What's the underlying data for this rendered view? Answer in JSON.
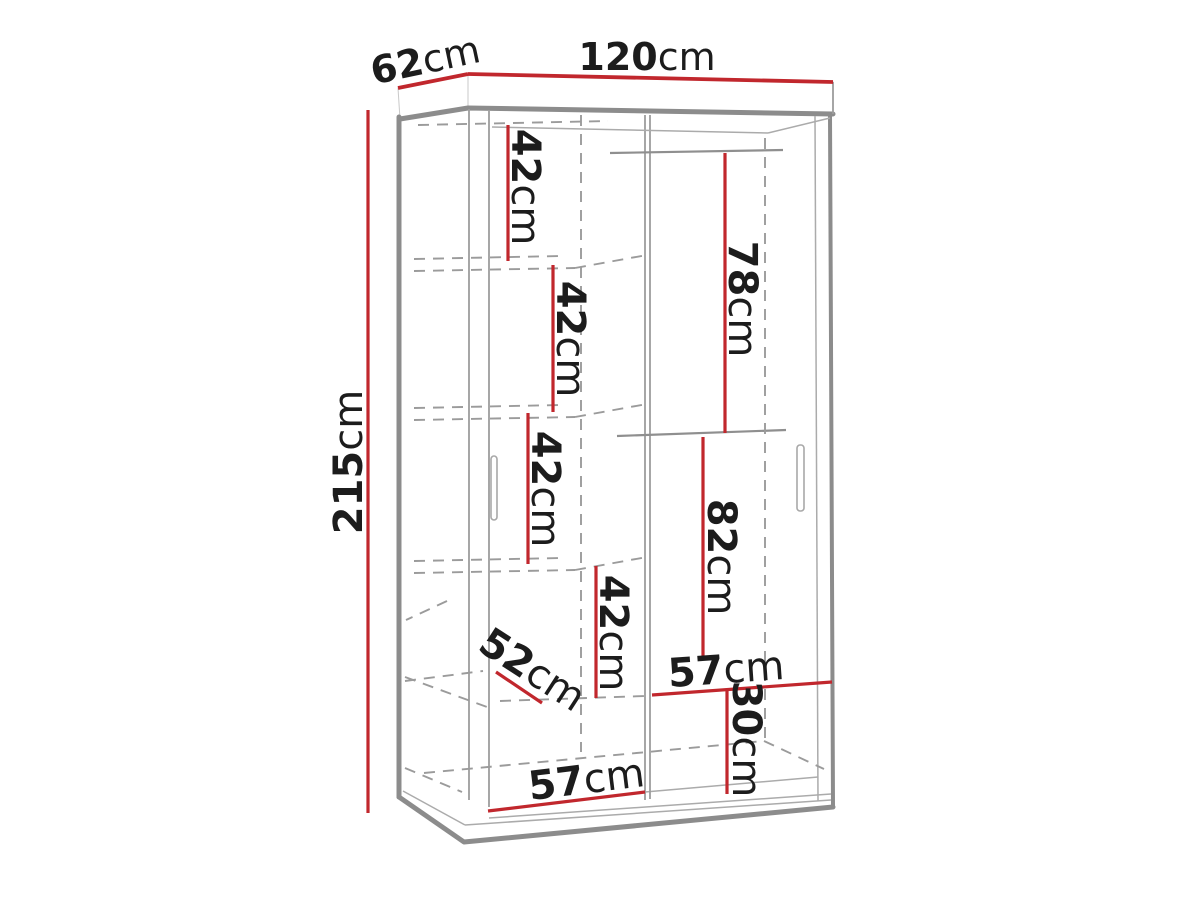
{
  "diagram": {
    "type": "furniture-dimension-drawing",
    "subject": "two-door sliding wardrobe with shelves and hanging sections",
    "unit": "cm",
    "overall": {
      "width_cm": 120,
      "depth_cm": 62,
      "height_cm": 215
    },
    "colors": {
      "dimension_line": "#c1272d",
      "outline_gray": "#8c8c8c",
      "text": "#1c1c1c",
      "background": "#ffffff"
    }
  },
  "labels": [
    {
      "id": "overall-width",
      "number": "120",
      "unit": "cm"
    },
    {
      "id": "overall-depth",
      "number": "62",
      "unit": "cm"
    },
    {
      "id": "overall-height",
      "number": "215",
      "unit": "cm"
    },
    {
      "id": "shelf-gap-1",
      "number": "42",
      "unit": "cm"
    },
    {
      "id": "shelf-gap-2",
      "number": "42",
      "unit": "cm"
    },
    {
      "id": "shelf-gap-3",
      "number": "42",
      "unit": "cm"
    },
    {
      "id": "shelf-gap-4",
      "number": "42",
      "unit": "cm"
    },
    {
      "id": "hanging-upper-height",
      "number": "78",
      "unit": "cm"
    },
    {
      "id": "hanging-lower-height",
      "number": "82",
      "unit": "cm"
    },
    {
      "id": "shelf-depth",
      "number": "52",
      "unit": "cm"
    },
    {
      "id": "right-section-width",
      "number": "57",
      "unit": "cm"
    },
    {
      "id": "bottom-compartment",
      "number": "30",
      "unit": "cm"
    },
    {
      "id": "left-section-width",
      "number": "57",
      "unit": "cm"
    }
  ]
}
